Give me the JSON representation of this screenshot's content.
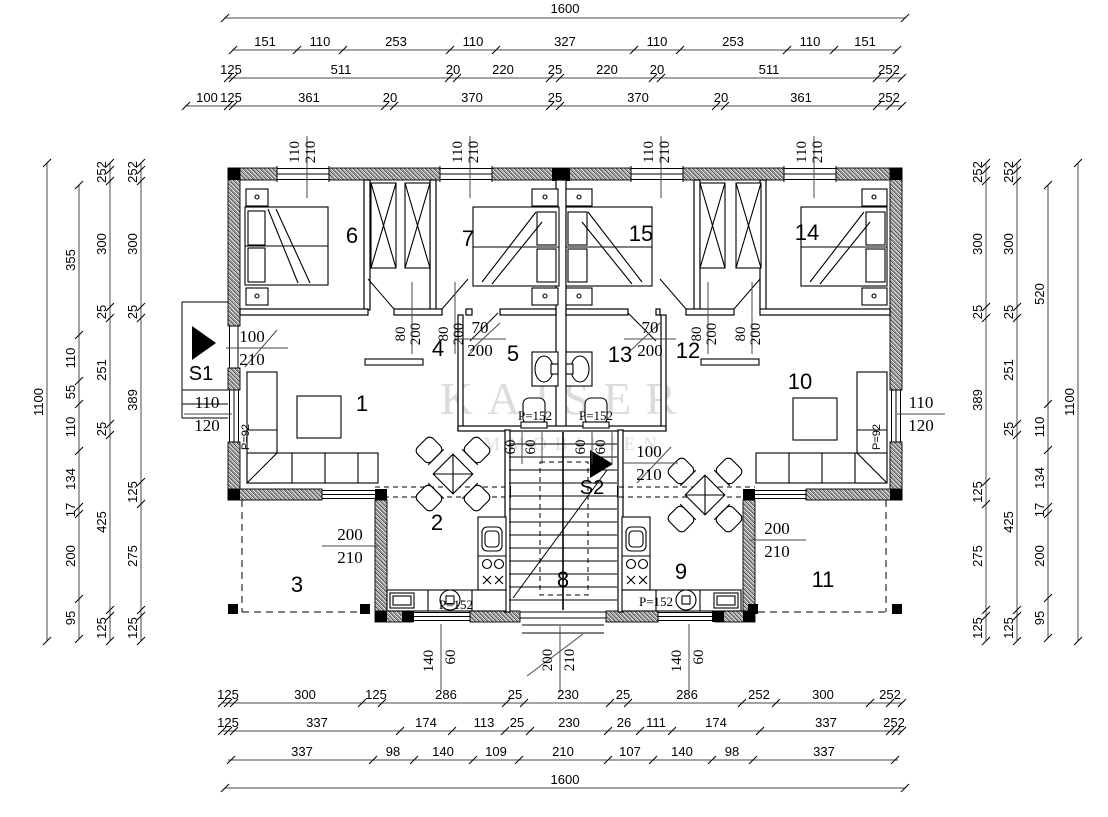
{
  "watermark": {
    "title": "KAISER",
    "subtitle": "IMMOBILIEN"
  },
  "markers": {
    "s1": "S1",
    "s2": "S2"
  },
  "rooms": {
    "n1": "1",
    "n2": "2",
    "n3": "3",
    "n4": "4",
    "n5": "5",
    "n6": "6",
    "n7": "7",
    "n8": "8",
    "n9": "9",
    "n10": "10",
    "n11": "11",
    "n12": "12",
    "n13": "13",
    "n14": "14",
    "n15": "15"
  },
  "labels": {
    "p152": "P=152",
    "p92": "P=92",
    "window_top": [
      "110",
      "210"
    ],
    "door_80": [
      "80",
      "200"
    ],
    "door_70": [
      "70",
      "200"
    ],
    "door_100": [
      "100",
      "210"
    ],
    "window_side": [
      "110",
      "120"
    ],
    "door_200": [
      "200",
      "210"
    ],
    "window_bottom": [
      "140",
      "60"
    ],
    "dim60": "60"
  },
  "dims": {
    "top": {
      "total": "1600",
      "row2": [
        "151",
        "110",
        "253",
        "110",
        "327",
        "110",
        "253",
        "110",
        "151"
      ],
      "row3": [
        "125",
        "511",
        "20",
        "220",
        "25",
        "220",
        "20",
        "511",
        "252"
      ],
      "row4": [
        "100",
        "125",
        "361",
        "20",
        "370",
        "25",
        "370",
        "20",
        "361",
        "252"
      ]
    },
    "bottom": {
      "row1": [
        "125",
        "300",
        "125",
        "286",
        "25",
        "230",
        "25",
        "286",
        "252",
        "300",
        "252"
      ],
      "row2": [
        "125",
        "337",
        "174",
        "113",
        "25",
        "230",
        "26",
        "111",
        "174",
        "337",
        "252"
      ],
      "row3": [
        "337",
        "98",
        "140",
        "109",
        "210",
        "107",
        "140",
        "98",
        "337"
      ],
      "total": "1600"
    },
    "left": {
      "total": "1100",
      "row2": [
        "355",
        "110",
        "55",
        "110",
        "134",
        "17",
        "200",
        "95"
      ],
      "row3": [
        "252",
        "300",
        "25",
        "251",
        "25",
        "425",
        "125"
      ],
      "row4": [
        "252",
        "300",
        "25",
        "389",
        "125",
        "275",
        "125"
      ]
    },
    "right": {
      "row1": [
        "252",
        "300",
        "25",
        "389",
        "125",
        "275",
        "125"
      ],
      "row2": [
        "252",
        "300",
        "25",
        "251",
        "25",
        "425",
        "125"
      ],
      "row3": [
        "520",
        "110",
        "134",
        "17",
        "200",
        "95"
      ],
      "total": "1100"
    }
  }
}
